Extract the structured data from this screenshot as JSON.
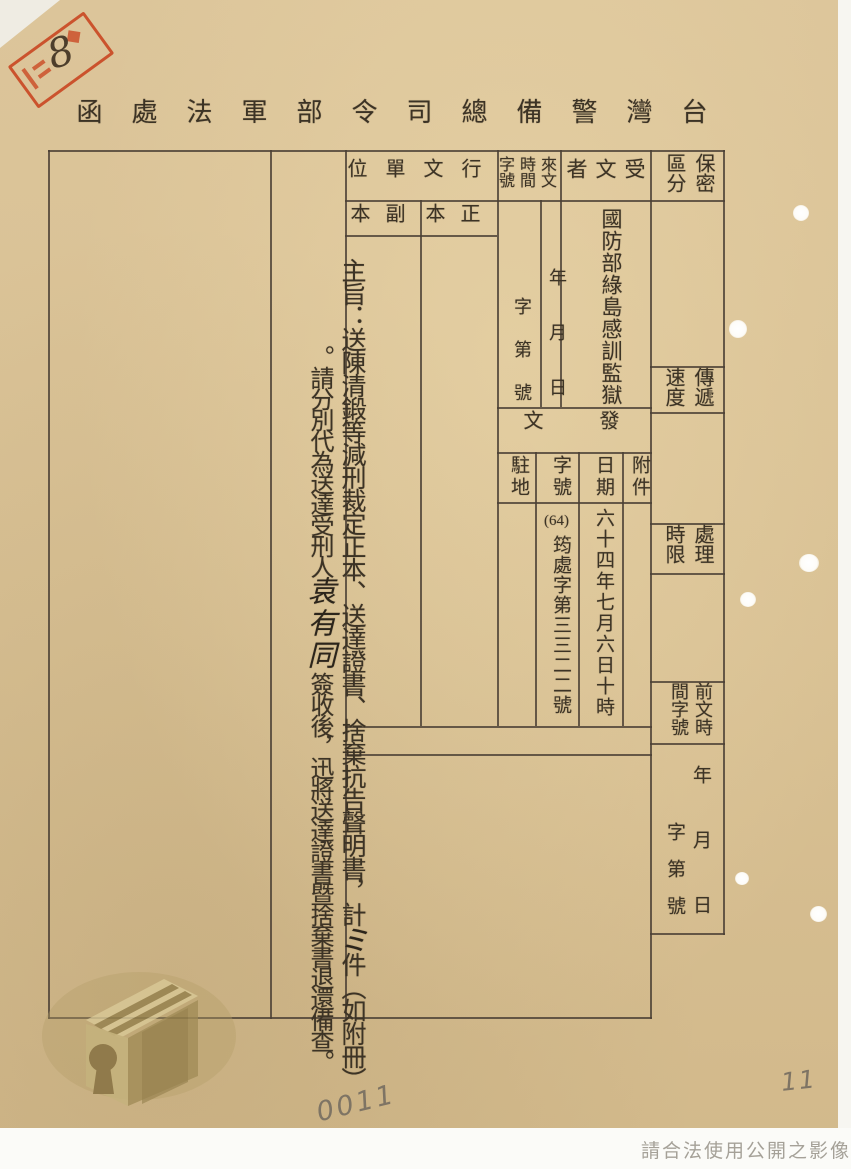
{
  "document": {
    "title": "台灣警備總司令部軍法處函",
    "copyright_notice": "請合法使用公開之影像",
    "pencil_page_number": "0011",
    "pencil_folio_number": "11",
    "stamp": {
      "handwritten_number": "8"
    }
  },
  "form": {
    "security_class": {
      "label": "保密區分",
      "value": ""
    },
    "transmit_speed": {
      "label": "傳遞速度",
      "value": ""
    },
    "process_deadline": {
      "label": "處理時限",
      "value": ""
    },
    "previous_doc": {
      "label": "前文時間字號",
      "date_placeholder": "年月日",
      "ref_placeholder": "字第號"
    },
    "recipient": {
      "label": "受文者",
      "value": "國防部綠島感訓監獄"
    },
    "incoming_doc": {
      "label": "來文時間字號",
      "date_placeholder": "年月日",
      "ref_placeholder": "字第號"
    },
    "dispatch": {
      "label": "發文",
      "attachment": {
        "label": "附件",
        "value": ""
      },
      "date": {
        "label": "日期",
        "value": "六十四年七月六日十時"
      },
      "ref_no": {
        "label": "字號",
        "prefix": "(64)",
        "value": "筠處字第三三二二號"
      },
      "station": {
        "label": "駐地",
        "value": ""
      }
    },
    "addressed_units": {
      "label": "行文單位",
      "original": "正本",
      "copy": "副本"
    },
    "subject": {
      "col1_text": "主旨：送陳清鍛等減刑裁定正本、送達證書、捨棄抗告聲明書，計",
      "count_handwritten": "ミ",
      "col1_tail": "件（如附冊）",
      "col2_text": "。請分別代為送達受刑人",
      "name_handwritten": "袁有同",
      "col2_tail": "簽收後，迅將送達證書暨捨棄書退還備查。"
    }
  },
  "colors": {
    "paper": "#d8c093",
    "ink": "#3c3325",
    "stamp_red": "#c83e1a",
    "pencil": "#7e7464",
    "logo_olive": "#a18c57"
  }
}
